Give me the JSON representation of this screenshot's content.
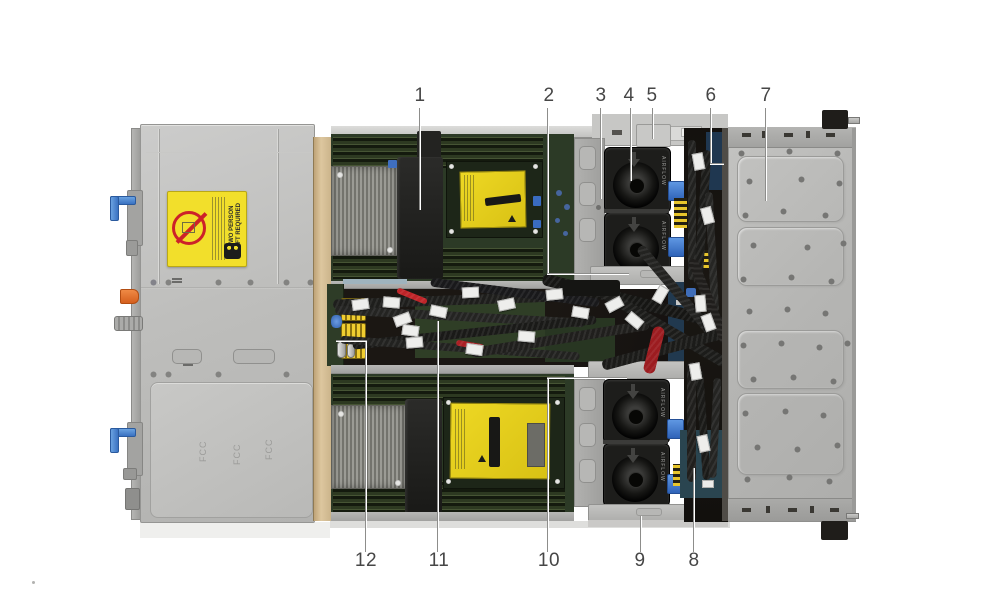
{
  "figure": {
    "kind": "server-internal-top-view-callout-diagram",
    "callout_count": 12
  },
  "callouts": [
    {
      "number": "1"
    },
    {
      "number": "2"
    },
    {
      "number": "3"
    },
    {
      "number": "4"
    },
    {
      "number": "5"
    },
    {
      "number": "6"
    },
    {
      "number": "7"
    },
    {
      "number": "8"
    },
    {
      "number": "9"
    },
    {
      "number": "10"
    },
    {
      "number": "11"
    },
    {
      "number": "12"
    }
  ],
  "stickers": {
    "caution_line1": "TWO PERSON",
    "caution_line2": "LIFT REQUIRED"
  },
  "embossed_text": "FCC",
  "fan_text": "AIRFLOW",
  "colors": {
    "caution_label_yellow": "#f2df2b",
    "socket_cover_yellow": "#e6d020",
    "warning_red": "#cc2229",
    "latch_blue": "#4a86d8",
    "tab_orange": "#e0702f",
    "pcb_green": "#2c3a26",
    "chassis_gray": "#bcbcba",
    "callout_line_gray": "#8d8d8b"
  }
}
